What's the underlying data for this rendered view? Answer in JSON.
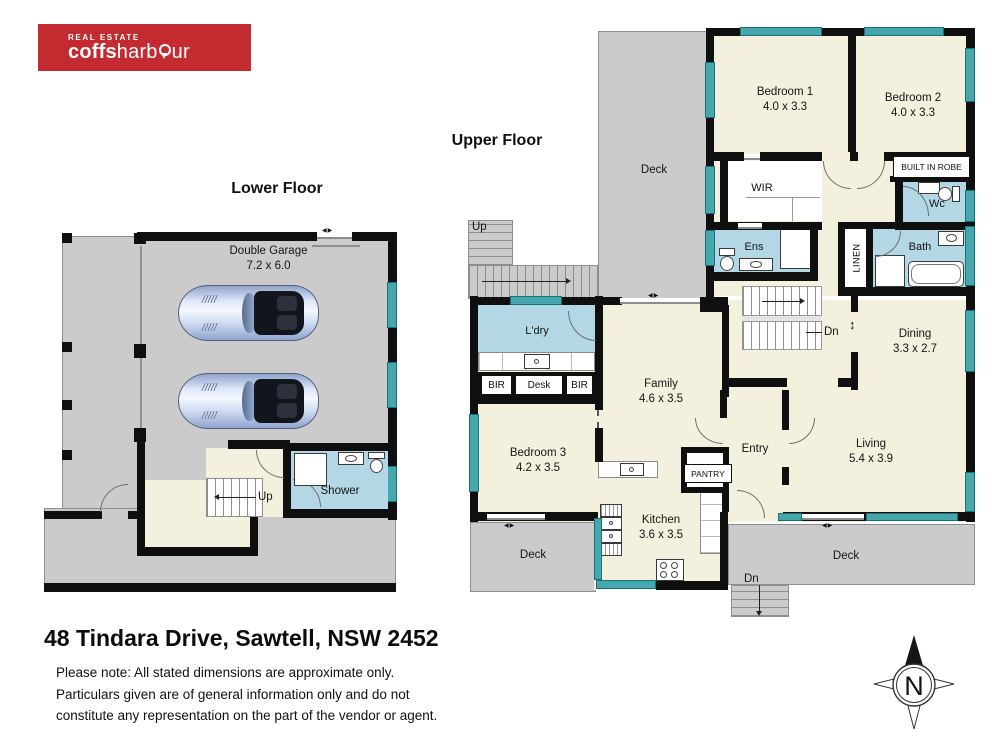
{
  "logo": {
    "tagline": "REAL ESTATE",
    "brand_bold": "coffs",
    "brand_rest_a": "harb",
    "brand_rest_b": "ur"
  },
  "floors": {
    "lower": {
      "title": "Lower Floor",
      "garage": {
        "name": "Double Garage",
        "dims": "7.2 x 6.0"
      },
      "stairs_up": "Up",
      "shower": "Shower"
    },
    "upper": {
      "title": "Upper Floor",
      "deck_top": "Deck",
      "deck_bottom_left": "Deck",
      "deck_bottom_right": "Deck",
      "stairs_up": "Up",
      "stairs_down_internal": "Dn",
      "stairs_down_external": "Dn",
      "bedroom1": {
        "name": "Bedroom 1",
        "dims": "4.0 x 3.3"
      },
      "bedroom2": {
        "name": "Bedroom 2",
        "dims": "4.0 x 3.3"
      },
      "bedroom3": {
        "name": "Bedroom 3",
        "dims": "4.2 x 3.5"
      },
      "family": {
        "name": "Family",
        "dims": "4.6 x 3.5"
      },
      "dining": {
        "name": "Dining",
        "dims": "3.3 x 2.7"
      },
      "living": {
        "name": "Living",
        "dims": "5.4 x 3.9"
      },
      "kitchen": {
        "name": "Kitchen",
        "dims": "3.6 x 3.5"
      },
      "wir": "WIR",
      "built_in_robe": "BUILT IN ROBE",
      "wc": "Wc",
      "ens": "Ens",
      "bath": "Bath",
      "linen": "LINEN",
      "ldry": "L'dry",
      "bir_left": "BIR",
      "desk": "Desk",
      "bir_right": "BIR",
      "entry": "Entry",
      "pantry": "PANTRY"
    }
  },
  "footer": {
    "address": "48 Tindara Drive, Sawtell, NSW 2452",
    "note_lines": [
      "Please note: All stated dimensions are approximate only.",
      "Particulars given are of general information only and do not",
      "constitute any representation on the part of the vendor or agent."
    ]
  },
  "compass": {
    "north": "N"
  },
  "icons": {
    "double_arrow_h": "◀▶",
    "double_arrow_v": "↕"
  },
  "colors": {
    "logo_red": "#c32b31",
    "wall_black": "#0f0f0f",
    "floor_cream": "#f4f0de",
    "wet_blue": "#b4d7e5",
    "deck_grey": "#cbcbcb",
    "window_teal": "#46a8ad"
  }
}
